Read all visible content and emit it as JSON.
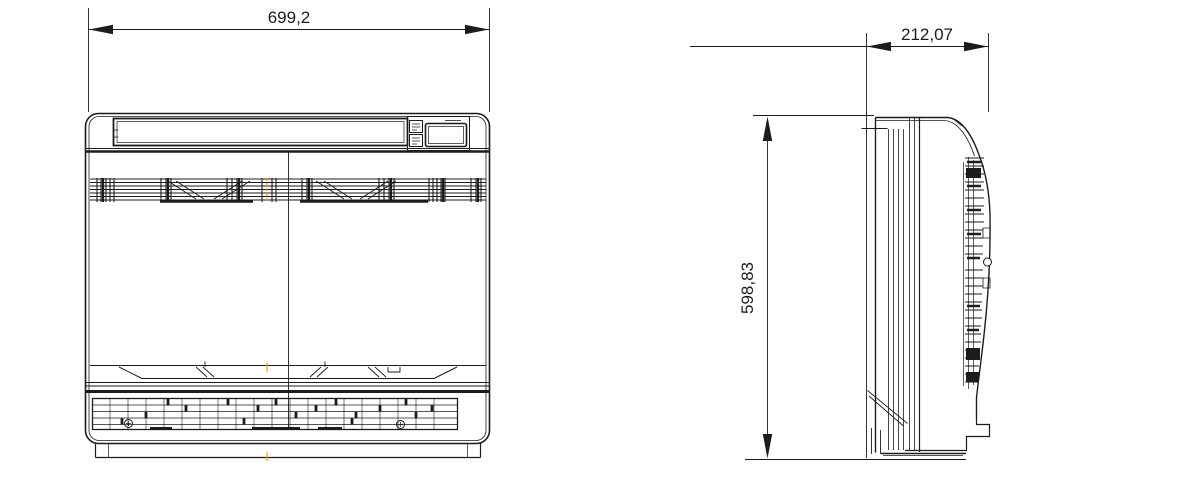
{
  "drawing": {
    "type": "technical-dimension-drawing",
    "subject": "floor-console-unit",
    "background_color": "#ffffff",
    "line_color": "#1c1c1c",
    "centerline_color": "#e3a417",
    "views": {
      "front_view": "front view",
      "side_view": "side view"
    },
    "dimensions": {
      "width": {
        "label": "699,2"
      },
      "depth": {
        "label": "212,07"
      },
      "height": {
        "label": "598,83"
      }
    }
  }
}
